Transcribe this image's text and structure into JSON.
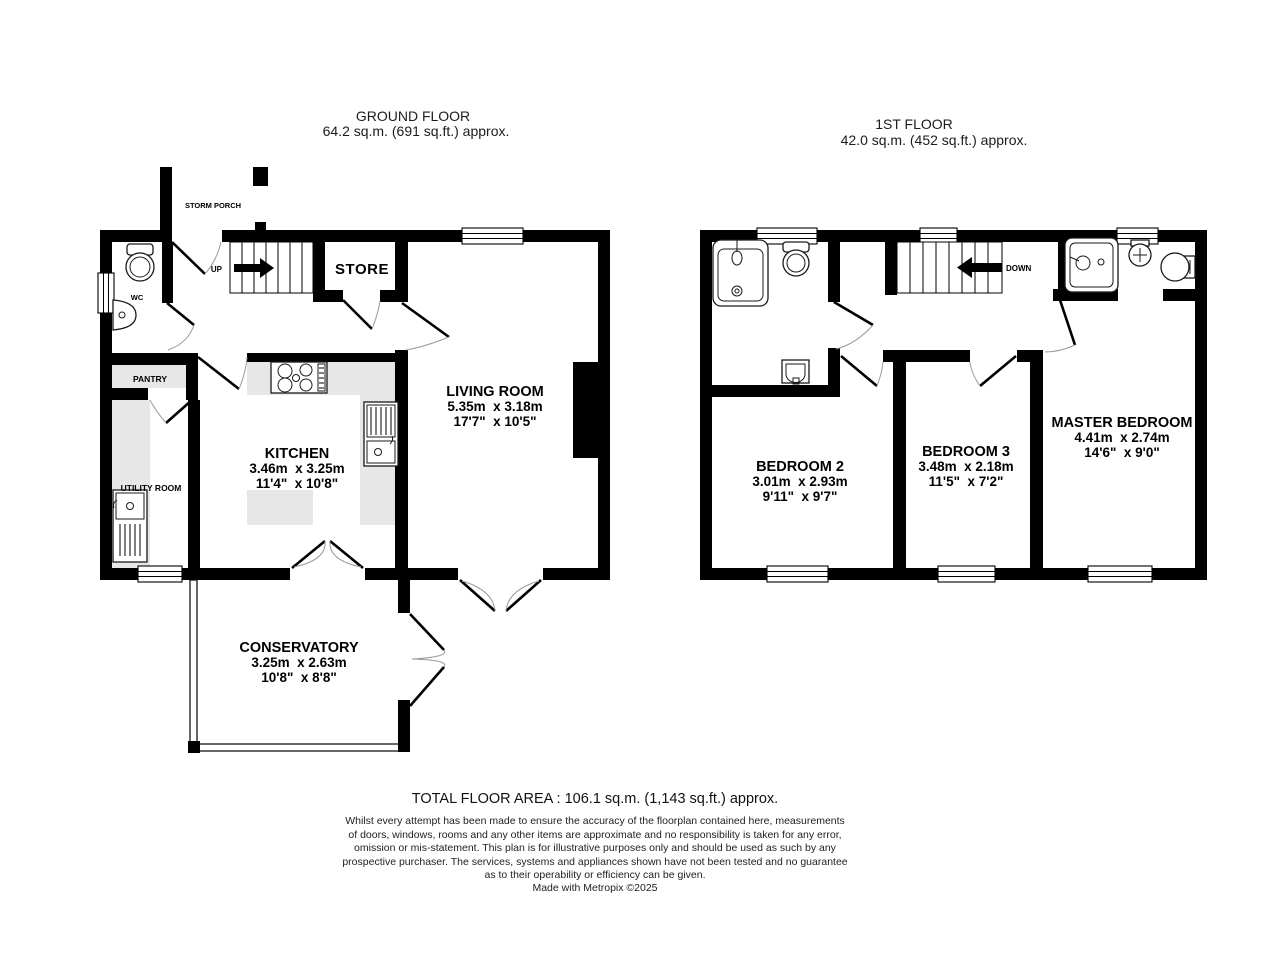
{
  "ground_floor": {
    "title": "GROUND FLOOR",
    "area": "64.2 sq.m. (691 sq.ft.) approx.",
    "rooms": {
      "storm_porch": "STORM PORCH",
      "wc": "WC",
      "up": "UP",
      "store": "STORE",
      "pantry": "PANTRY",
      "utility": "UTILITY ROOM",
      "kitchen": {
        "name": "KITCHEN",
        "metric": "3.46m  x 3.25m",
        "imperial": "11'4\"  x 10'8\""
      },
      "living": {
        "name": "LIVING ROOM",
        "metric": "5.35m  x 3.18m",
        "imperial": "17'7\"  x 10'5\""
      },
      "conservatory": {
        "name": "CONSERVATORY",
        "metric": "3.25m  x 2.63m",
        "imperial": "10'8\"  x 8'8\""
      }
    }
  },
  "first_floor": {
    "title": "1ST FLOOR",
    "area": "42.0 sq.m. (452 sq.ft.) approx.",
    "rooms": {
      "down": "DOWN",
      "bedroom2": {
        "name": "BEDROOM 2",
        "metric": "3.01m  x 2.93m",
        "imperial": "9'11\"  x 9'7\""
      },
      "bedroom3": {
        "name": "BEDROOM 3",
        "metric": "3.48m  x 2.18m",
        "imperial": "11'5\"  x 7'2\""
      },
      "master": {
        "name": "MASTER BEDROOM",
        "metric": "4.41m  x 2.74m",
        "imperial": "14'6\"  x 9'0\""
      }
    }
  },
  "footer": {
    "total": "TOTAL FLOOR AREA : 106.1 sq.m. (1,143 sq.ft.) approx.",
    "disclaimer_lines": [
      "Whilst every attempt has been made to ensure the accuracy of the floorplan contained here, measurements",
      "of doors, windows, rooms and any other items are approximate and no responsibility is taken for any error,",
      "omission or mis-statement. This plan is for illustrative purposes only and should be used as such by any",
      "prospective purchaser. The services, systems and appliances shown have not been tested and no guarantee",
      "as to their operability or efficiency can be given."
    ],
    "credit": "Made with Metropix ©2025"
  },
  "colors": {
    "wall": "#000000",
    "counter": "#e7e7e7",
    "background": "#ffffff"
  }
}
